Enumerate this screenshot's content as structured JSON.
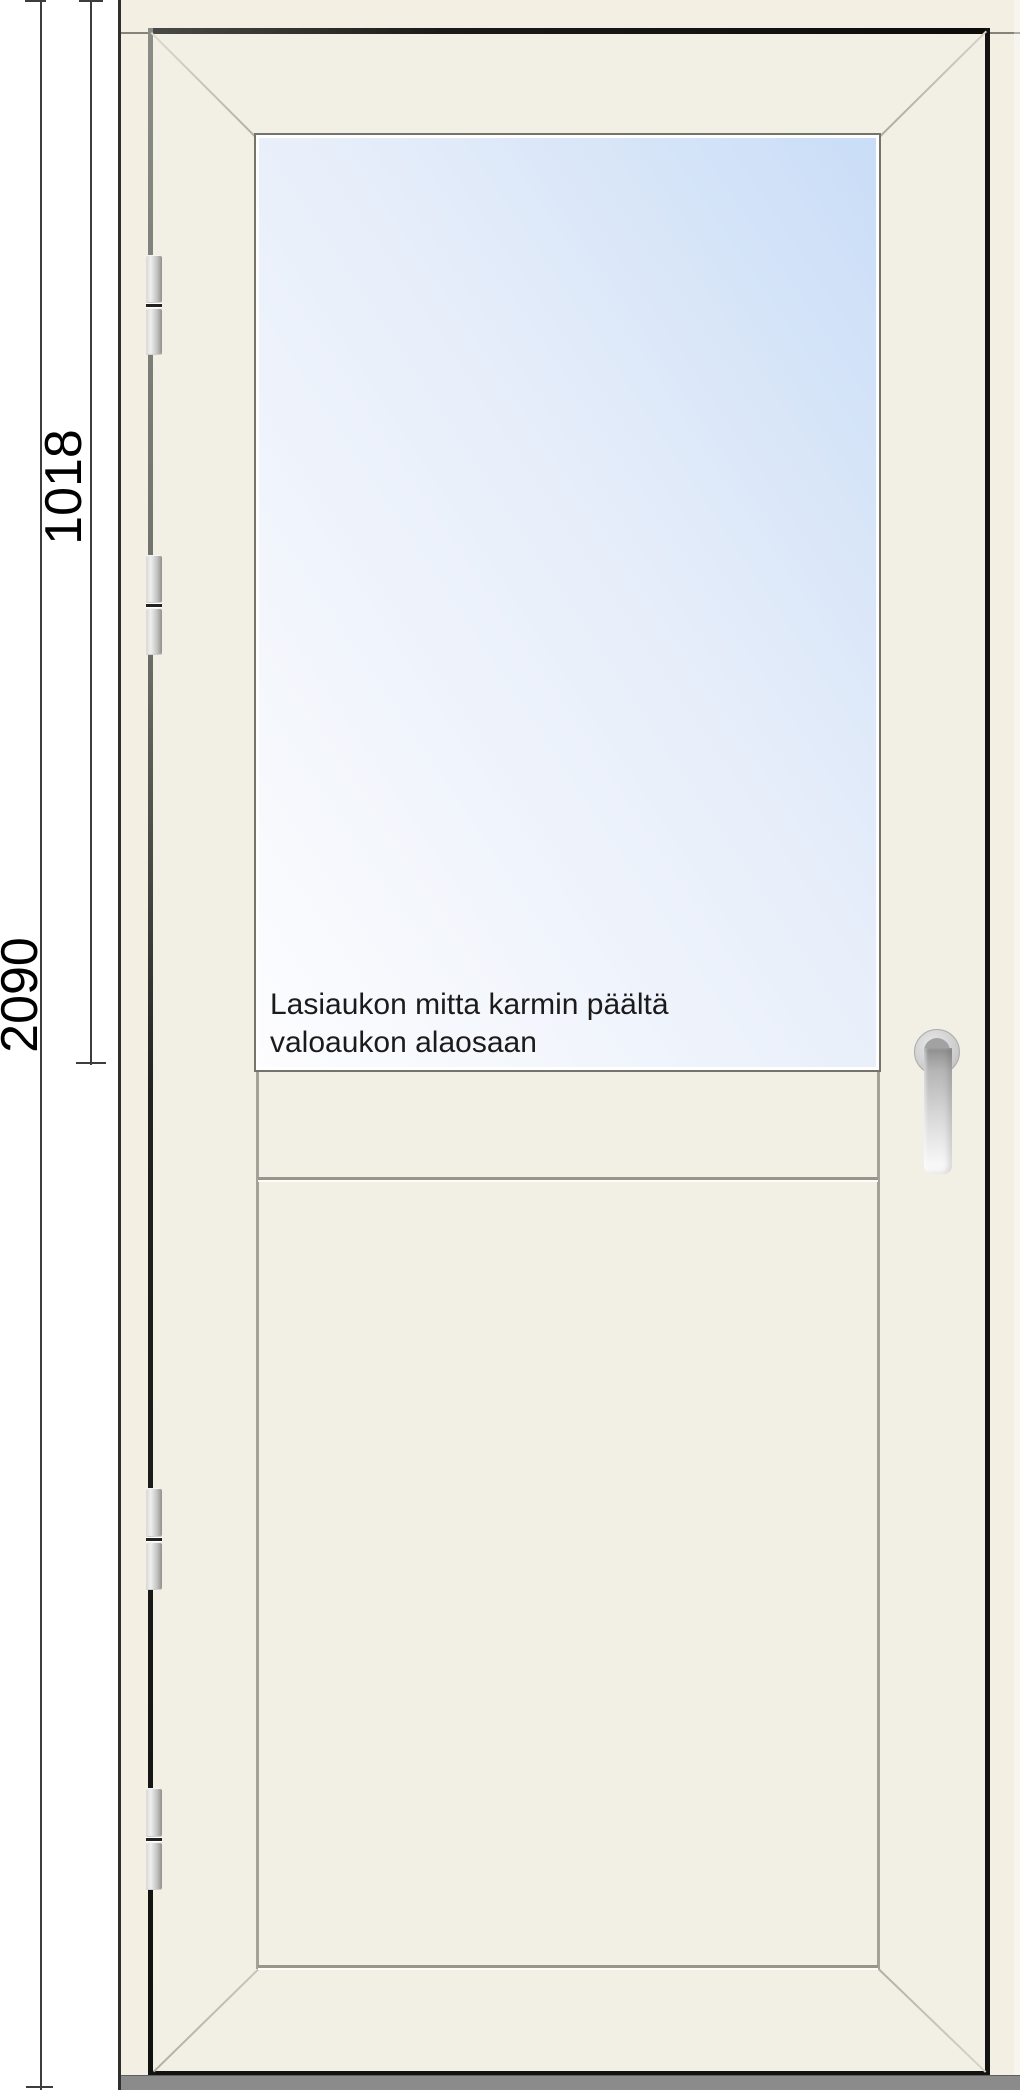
{
  "dimensions": {
    "total_height": "2090",
    "glass_opening_height": "1018"
  },
  "annotation": {
    "line1": "Lasiaukon mitta karmin päältä",
    "line2": "valoaukon alaosaan"
  },
  "parts": {
    "hinge_count": 4
  },
  "colors": {
    "frame_cream": "#f3f0e3",
    "leaf_cream": "#f2efe4",
    "glass_blue_top": "#c9ddf7",
    "glass_white_bottom": "#fdfdfe",
    "sill_gray": "#8b8b8b",
    "outline_dark": "#131311",
    "dimension_line": "#3d3d3d",
    "bevel_line": "#bcb9ac",
    "handle_silver": "#d9d9d9"
  }
}
